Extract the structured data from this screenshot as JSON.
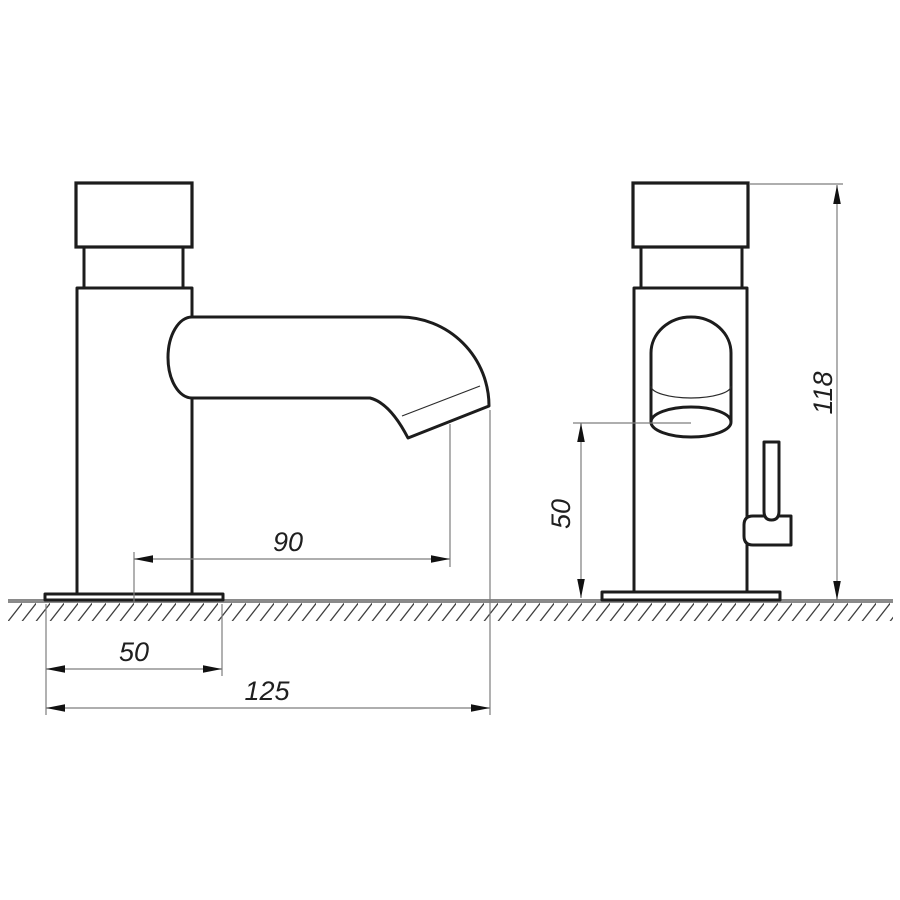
{
  "drawing": {
    "title": "faucet-two-view-dimensional-drawing",
    "views": {
      "side_view": "faucet side profile with spout",
      "front_view": "faucet front with outlet and side handle"
    },
    "dimensions": {
      "spout_reach": {
        "label": "90",
        "orientation": "horizontal"
      },
      "base_depth": {
        "label": "50",
        "orientation": "horizontal"
      },
      "overall_depth": {
        "label": "125",
        "orientation": "horizontal"
      },
      "spout_height": {
        "label": "50",
        "orientation": "vertical"
      },
      "overall_height": {
        "label": "118",
        "orientation": "vertical"
      }
    },
    "colors": {
      "background": "#ffffff",
      "outline": "#1c1c1c",
      "thin_line": "#2a2a2a",
      "dimension_line": "#7d7d7d",
      "arrow": "#111111",
      "ground_line": "#8a8a8a",
      "hatch": "#3f3f3f",
      "text": "#1f1f1f"
    }
  }
}
